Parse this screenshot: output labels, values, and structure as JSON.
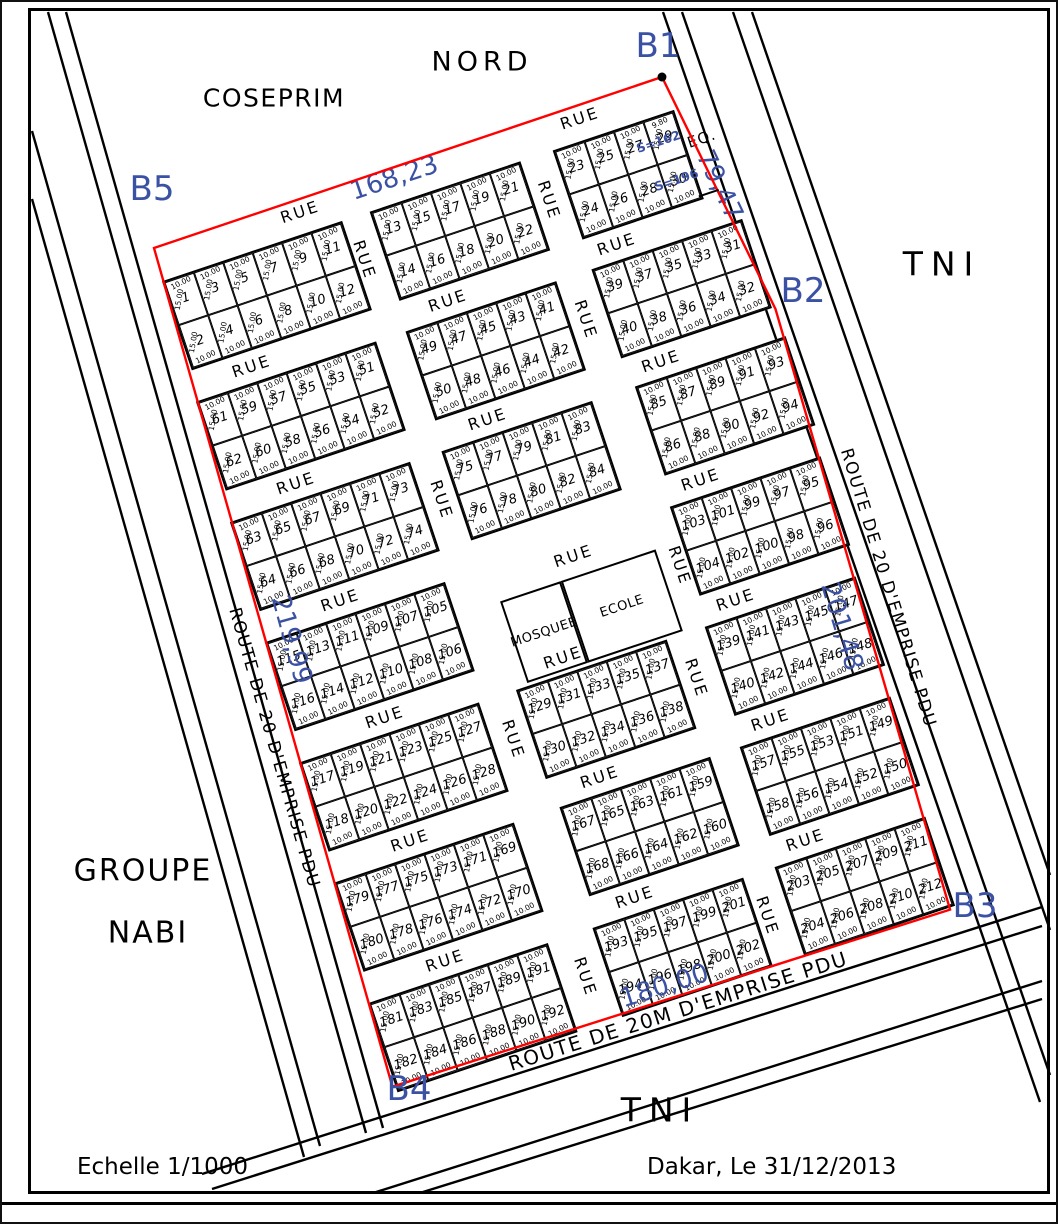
{
  "colors": {
    "red": "#ff0000",
    "blue": "#3b51a3",
    "line": "#000000",
    "bg": "#ffffff"
  },
  "labels": {
    "nord": "NORD",
    "coseprim": "COSEPRIM",
    "tni_right": "TNI",
    "tni_bottom": "TNI",
    "groupe": "GROUPE",
    "nabi": "NABI",
    "echelle": "Echelle 1/1000",
    "date": "Dakar, Le 31/12/2013",
    "rue": "RUE",
    "eq": "EQ.",
    "s162": "S=162",
    "s196": "S=196",
    "mosquee": "MOSQUEE",
    "ecole": "ECOLE"
  },
  "markers": [
    {
      "id": "b1",
      "text": "B1",
      "x": 656,
      "y": 44
    },
    {
      "id": "b2",
      "text": "B2",
      "x": 801,
      "y": 289
    },
    {
      "id": "b3",
      "text": "B3",
      "x": 973,
      "y": 904
    },
    {
      "id": "b4",
      "text": "B4",
      "x": 407,
      "y": 1087
    },
    {
      "id": "b5",
      "text": "B5",
      "x": 150,
      "y": 187
    }
  ],
  "plan": {
    "origin_x": 152,
    "origin_y": 246,
    "rotation_deg": -18.5,
    "boundary": [
      [
        0,
        0
      ],
      [
        536,
        -1
      ],
      [
        570,
        255
      ],
      [
        545,
        880
      ],
      [
        -40,
        871
      ]
    ],
    "b1_dot": [
      536,
      -1
    ],
    "eq_line": [
      533,
      124,
      554,
      124
    ],
    "eq_pos": {
      "x": 554,
      "y": 70
    },
    "s162_pos": {
      "x": 512,
      "y": 59
    },
    "s196_pos": {
      "x": 517,
      "y": 101
    },
    "measures": [
      {
        "text": "168,23",
        "x": 250,
        "y": 10,
        "rot": 0
      },
      {
        "text": "79,47",
        "x": 556,
        "y": 120,
        "rot": 83
      },
      {
        "text": "201,48",
        "x": 532,
        "y": 577,
        "rot": 92
      },
      {
        "text": "219,99",
        "x": 6,
        "y": 415,
        "rot": 93
      },
      {
        "text": "180,00",
        "x": 250,
        "y": 862,
        "rot": 1
      }
    ],
    "rue_labels": [
      {
        "x": 150,
        "y": 12,
        "v": false
      },
      {
        "x": 445,
        "y": 12,
        "v": false
      },
      {
        "x": 55,
        "y": 143,
        "v": false
      },
      {
        "x": 262,
        "y": 143,
        "v": false
      },
      {
        "x": 440,
        "y": 143,
        "v": false
      },
      {
        "x": 60,
        "y": 268,
        "v": false
      },
      {
        "x": 262,
        "y": 268,
        "v": false
      },
      {
        "x": 445,
        "y": 268,
        "v": false
      },
      {
        "x": 65,
        "y": 393,
        "v": false
      },
      {
        "x": 300,
        "y": 425,
        "v": false
      },
      {
        "x": 445,
        "y": 393,
        "v": false
      },
      {
        "x": 70,
        "y": 518,
        "v": false
      },
      {
        "x": 258,
        "y": 518,
        "v": false
      },
      {
        "x": 440,
        "y": 518,
        "v": false
      },
      {
        "x": 55,
        "y": 643,
        "v": false
      },
      {
        "x": 255,
        "y": 643,
        "v": false
      },
      {
        "x": 435,
        "y": 643,
        "v": false
      },
      {
        "x": 50,
        "y": 768,
        "v": false
      },
      {
        "x": 250,
        "y": 768,
        "v": false
      },
      {
        "x": 430,
        "y": 768,
        "v": false
      },
      {
        "x": 196,
        "y": 78,
        "v": true
      },
      {
        "x": 390,
        "y": 80,
        "v": true
      },
      {
        "x": 387,
        "y": 205,
        "v": true
      },
      {
        "x": 193,
        "y": 330,
        "v": true
      },
      {
        "x": 398,
        "y": 468,
        "v": true
      },
      {
        "x": 185,
        "y": 580,
        "v": true
      },
      {
        "x": 378,
        "y": 580,
        "v": true
      },
      {
        "x": 178,
        "y": 828,
        "v": true
      },
      {
        "x": 370,
        "y": 828,
        "v": true
      }
    ],
    "landmarks": [
      {
        "label_key": "mosquee",
        "x": 216,
        "y": 445,
        "w": 64,
        "h": 86
      },
      {
        "label_key": "ecole",
        "x": 280,
        "y": 445,
        "w": 100,
        "h": 86
      }
    ],
    "lot": {
      "w": 31,
      "h": 45,
      "width_dim": "10.00",
      "depth_dim": "15.00"
    },
    "blocks": [
      {
        "x": -3,
        "y": 34,
        "top": [
          1,
          3,
          5,
          7,
          9,
          11
        ],
        "bottom": [
          2,
          4,
          6,
          8,
          10,
          12
        ]
      },
      {
        "x": 216,
        "y": 34,
        "top": [
          13,
          15,
          17,
          19,
          21
        ],
        "bottom": [
          14,
          16,
          18,
          20,
          22
        ]
      },
      {
        "x": 409,
        "y": 34,
        "top": [
          23,
          25,
          27,
          29
        ],
        "bottom": [
          24,
          26,
          28,
          30
        ],
        "dim_overrides": {
          "29": "9.80"
        }
      },
      {
        "x": -9,
        "y": 159,
        "top": [
          61,
          59,
          57,
          55,
          53,
          51
        ],
        "bottom": [
          62,
          60,
          58,
          56,
          54,
          52
        ]
      },
      {
        "x": 212,
        "y": 159,
        "top": [
          49,
          47,
          45,
          43,
          41
        ],
        "bottom": [
          50,
          48,
          46,
          44,
          42
        ]
      },
      {
        "x": 408,
        "y": 159,
        "top": [
          39,
          37,
          35,
          33,
          31
        ],
        "bottom": [
          40,
          38,
          36,
          34,
          32
        ]
      },
      {
        "x": -15,
        "y": 284,
        "top": [
          63,
          65,
          67,
          69,
          71,
          73
        ],
        "bottom": [
          64,
          66,
          68,
          70,
          72,
          74
        ]
      },
      {
        "x": 208,
        "y": 284,
        "top": [
          75,
          77,
          79,
          81,
          83
        ],
        "bottom": [
          76,
          78,
          80,
          82,
          84
        ]
      },
      {
        "x": 412,
        "y": 284,
        "top": [
          85,
          87,
          89,
          91,
          93
        ],
        "bottom": [
          86,
          88,
          90,
          92,
          94
        ]
      },
      {
        "x": -20,
        "y": 409,
        "top": [
          115,
          113,
          111,
          109,
          107,
          105
        ],
        "bottom": [
          116,
          114,
          112,
          110,
          108,
          106
        ]
      },
      {
        "x": 407,
        "y": 409,
        "top": [
          103,
          101,
          99,
          97,
          95
        ],
        "bottom": [
          104,
          102,
          100,
          98,
          96
        ]
      },
      {
        "x": -26,
        "y": 534,
        "top": [
          117,
          119,
          121,
          123,
          125,
          127
        ],
        "bottom": [
          118,
          120,
          122,
          124,
          126,
          128
        ]
      },
      {
        "x": 203,
        "y": 534,
        "top": [
          129,
          131,
          133,
          135,
          137
        ],
        "bottom": [
          130,
          132,
          134,
          136,
          138
        ]
      },
      {
        "x": 402,
        "y": 534,
        "top": [
          139,
          141,
          143,
          145,
          147
        ],
        "bottom": [
          140,
          142,
          144,
          146,
          148
        ]
      },
      {
        "x": -31,
        "y": 659,
        "top": [
          179,
          177,
          175,
          173,
          171,
          169
        ],
        "bottom": [
          180,
          178,
          176,
          174,
          172,
          170
        ]
      },
      {
        "x": 207,
        "y": 659,
        "top": [
          167,
          165,
          163,
          161,
          159
        ],
        "bottom": [
          168,
          166,
          164,
          162,
          160
        ]
      },
      {
        "x": 397,
        "y": 659,
        "top": [
          157,
          155,
          153,
          151,
          149
        ],
        "bottom": [
          158,
          156,
          154,
          152,
          150
        ]
      },
      {
        "x": -37,
        "y": 784,
        "top": [
          181,
          183,
          185,
          187,
          189,
          191
        ],
        "bottom": [
          182,
          184,
          186,
          188,
          190,
          192
        ]
      },
      {
        "x": 200,
        "y": 784,
        "top": [
          193,
          195,
          197,
          199,
          201
        ],
        "bottom": [
          194,
          196,
          198,
          200,
          202
        ]
      },
      {
        "x": 392,
        "y": 784,
        "top": [
          203,
          205,
          207,
          209,
          211
        ],
        "bottom": [
          204,
          206,
          208,
          210,
          212
        ]
      }
    ]
  },
  "roads": {
    "lines": [
      [
        64,
        10,
        381,
        1126
      ],
      [
        46,
        10,
        364,
        1131
      ],
      [
        30,
        129,
        318,
        1144
      ],
      [
        30,
        197,
        302,
        1155
      ],
      [
        661,
        10,
        1038,
        1100
      ],
      [
        680,
        10,
        1048,
        1073
      ],
      [
        731,
        10,
        1048,
        928
      ],
      [
        750,
        10,
        1048,
        873
      ],
      [
        200,
        1172,
        1040,
        905
      ],
      [
        210,
        1187,
        1040,
        924
      ],
      [
        371,
        1191,
        1040,
        979
      ],
      [
        421,
        1190,
        1040,
        997
      ]
    ],
    "labels": [
      {
        "text": "ROUTE DE 20 D'EMPRISE PDU",
        "x": 272,
        "y": 746,
        "rot": 74,
        "size": "side"
      },
      {
        "text": "ROUTE DE 20 D'EMPRISE PDU",
        "x": 886,
        "y": 586,
        "rot": 73,
        "size": "side"
      },
      {
        "text": "ROUTE DE 20M D'EMPRISE PDU",
        "x": 676,
        "y": 1009,
        "rot": -17.5,
        "size": "bottom"
      }
    ]
  }
}
